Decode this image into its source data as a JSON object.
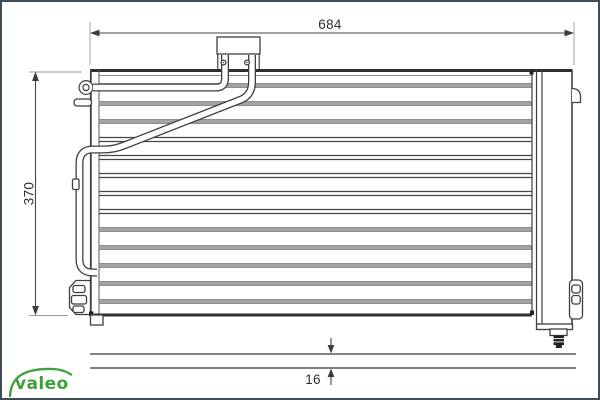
{
  "dimensions": {
    "width": "684",
    "height": "370",
    "depth": "16"
  },
  "brand": {
    "logo_text": "valeo",
    "color": "#3da03b"
  },
  "colors": {
    "line": "#3f3f3f",
    "dimension": "#454545",
    "fin_gray": "#a3a3a3",
    "frame": "#3e4d56",
    "background": "#ffffff"
  }
}
